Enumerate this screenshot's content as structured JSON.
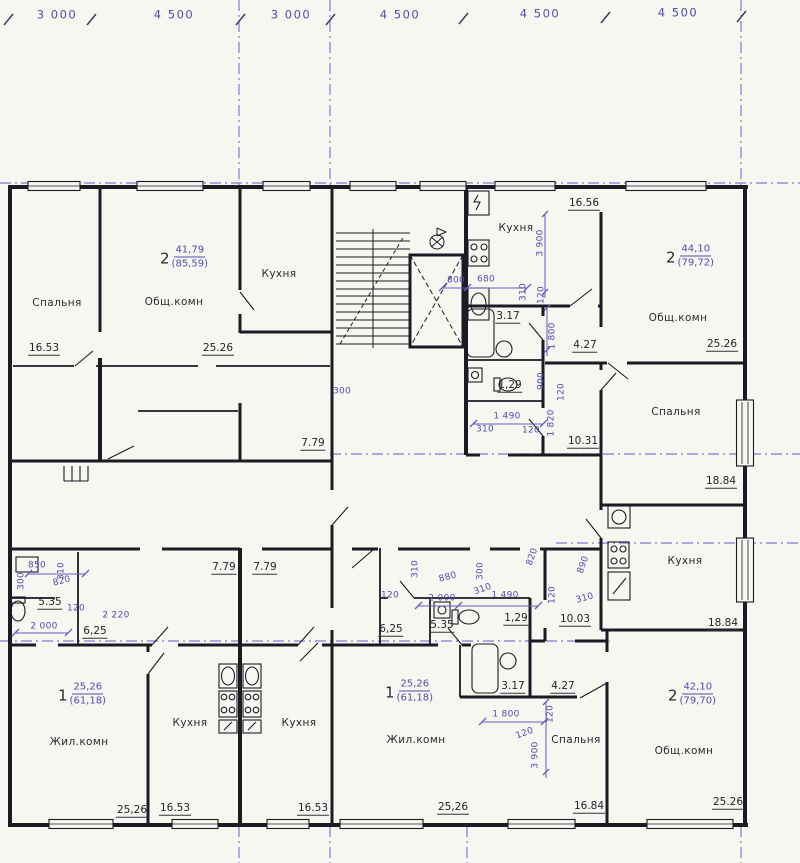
{
  "colors": {
    "paper": "#f7f6f1",
    "ink": "#1b1b24",
    "blue": "#4e4eae",
    "axis": "#7c7cd0"
  },
  "grid_dimensions": [
    {
      "text": "3 000",
      "x": 57,
      "y": 15
    },
    {
      "text": "4 500",
      "x": 174,
      "y": 15
    },
    {
      "text": "3 000",
      "x": 291,
      "y": 15
    },
    {
      "text": "4 500",
      "x": 400,
      "y": 15
    },
    {
      "text": "4 500",
      "x": 540,
      "y": 14
    },
    {
      "text": "4 500",
      "x": 678,
      "y": 13
    }
  ],
  "room_labels": [
    {
      "text": "Спальня",
      "x": 57,
      "y": 303
    },
    {
      "text": "Общ.комн",
      "x": 174,
      "y": 302
    },
    {
      "text": "Кухня",
      "x": 279,
      "y": 274
    },
    {
      "text": "Кухня",
      "x": 516,
      "y": 228
    },
    {
      "text": "Общ.комн",
      "x": 678,
      "y": 318
    },
    {
      "text": "Спальня",
      "x": 676,
      "y": 412
    },
    {
      "text": "Кухня",
      "x": 685,
      "y": 561
    },
    {
      "text": "Общ.комн",
      "x": 684,
      "y": 751
    },
    {
      "text": "Спальня",
      "x": 576,
      "y": 740
    },
    {
      "text": "Жил.комн",
      "x": 416,
      "y": 740
    },
    {
      "text": "Жил.комн",
      "x": 79,
      "y": 742
    },
    {
      "text": "Кухня",
      "x": 190,
      "y": 723
    },
    {
      "text": "Кухня",
      "x": 299,
      "y": 723
    }
  ],
  "area_labels": [
    {
      "text": "16.53",
      "x": 44,
      "y": 349
    },
    {
      "text": "25.26",
      "x": 218,
      "y": 349
    },
    {
      "text": "16.56",
      "x": 584,
      "y": 204
    },
    {
      "text": "25.26",
      "x": 722,
      "y": 345
    },
    {
      "text": "4.27",
      "x": 585,
      "y": 346
    },
    {
      "text": "3.17",
      "x": 508,
      "y": 317
    },
    {
      "text": "1,29",
      "x": 510,
      "y": 386
    },
    {
      "text": "10.31",
      "x": 583,
      "y": 442
    },
    {
      "text": "18.84",
      "x": 721,
      "y": 482
    },
    {
      "text": "18.84",
      "x": 723,
      "y": 624
    },
    {
      "text": "10.03",
      "x": 575,
      "y": 620
    },
    {
      "text": "7.79",
      "x": 313,
      "y": 444
    },
    {
      "text": "7.79",
      "x": 224,
      "y": 568
    },
    {
      "text": "7.79",
      "x": 265,
      "y": 568
    },
    {
      "text": "5.35",
      "x": 50,
      "y": 603
    },
    {
      "text": "6,25",
      "x": 95,
      "y": 632
    },
    {
      "text": "5.35",
      "x": 442,
      "y": 626
    },
    {
      "text": "6,25",
      "x": 391,
      "y": 630
    },
    {
      "text": "1,29",
      "x": 516,
      "y": 619
    },
    {
      "text": "3.17",
      "x": 513,
      "y": 687
    },
    {
      "text": "4.27",
      "x": 563,
      "y": 687
    },
    {
      "text": "16.84",
      "x": 589,
      "y": 807
    },
    {
      "text": "25.26",
      "x": 728,
      "y": 803
    },
    {
      "text": "25,26",
      "x": 132,
      "y": 811
    },
    {
      "text": "16.53",
      "x": 175,
      "y": 809
    },
    {
      "text": "16.53",
      "x": 313,
      "y": 809
    },
    {
      "text": "25,26",
      "x": 453,
      "y": 808
    }
  ],
  "apartment_labels": [
    {
      "num": "2",
      "area": "41,79",
      "total": "(85,59)",
      "x": 184,
      "y": 257
    },
    {
      "num": "2",
      "area": "44,10",
      "total": "(79,72)",
      "x": 690,
      "y": 256
    },
    {
      "num": "2",
      "area": "42,10",
      "total": "(79,70)",
      "x": 692,
      "y": 694
    },
    {
      "num": "1",
      "area": "25,26",
      "total": "(61,18)",
      "x": 409,
      "y": 691
    },
    {
      "num": "1",
      "area": "25,26",
      "total": "(61,18)",
      "x": 82,
      "y": 694
    }
  ],
  "dim_labels": [
    {
      "text": "800",
      "x": 456,
      "y": 281,
      "rot": 0
    },
    {
      "text": "680",
      "x": 486,
      "y": 280,
      "rot": 0
    },
    {
      "text": "3 900",
      "x": 541,
      "y": 243,
      "rot": -90
    },
    {
      "text": "310",
      "x": 524,
      "y": 292,
      "rot": -90
    },
    {
      "text": "120",
      "x": 542,
      "y": 295,
      "rot": -90
    },
    {
      "text": "1 800",
      "x": 553,
      "y": 336,
      "rot": -90
    },
    {
      "text": "900",
      "x": 542,
      "y": 381,
      "rot": -90
    },
    {
      "text": "120",
      "x": 562,
      "y": 392,
      "rot": -90
    },
    {
      "text": "1 490",
      "x": 507,
      "y": 417,
      "rot": 0
    },
    {
      "text": "310",
      "x": 485,
      "y": 430,
      "rot": 0
    },
    {
      "text": "120",
      "x": 531,
      "y": 431,
      "rot": 0
    },
    {
      "text": "1 820",
      "x": 552,
      "y": 423,
      "rot": -90
    },
    {
      "text": "300",
      "x": 342,
      "y": 392,
      "rot": 0
    },
    {
      "text": "890",
      "x": 584,
      "y": 565,
      "rot": -70
    },
    {
      "text": "310",
      "x": 585,
      "y": 599,
      "rot": -15
    },
    {
      "text": "850",
      "x": 37,
      "y": 566,
      "rot": 0
    },
    {
      "text": "310",
      "x": 62,
      "y": 571,
      "rot": -90
    },
    {
      "text": "820",
      "x": 62,
      "y": 582,
      "rot": -15
    },
    {
      "text": "300",
      "x": 22,
      "y": 581,
      "rot": -90
    },
    {
      "text": "120",
      "x": 76,
      "y": 609,
      "rot": 0
    },
    {
      "text": "2 220",
      "x": 116,
      "y": 616,
      "rot": 0
    },
    {
      "text": "2 000",
      "x": 44,
      "y": 627,
      "rot": 0
    },
    {
      "text": "310",
      "x": 416,
      "y": 569,
      "rot": -90
    },
    {
      "text": "880",
      "x": 448,
      "y": 578,
      "rot": -15
    },
    {
      "text": "120",
      "x": 390,
      "y": 596,
      "rot": 0
    },
    {
      "text": "2 000",
      "x": 442,
      "y": 599,
      "rot": 0
    },
    {
      "text": "300",
      "x": 481,
      "y": 571,
      "rot": -90
    },
    {
      "text": "310",
      "x": 483,
      "y": 590,
      "rot": -20
    },
    {
      "text": "1 490",
      "x": 505,
      "y": 596,
      "rot": 0
    },
    {
      "text": "820",
      "x": 533,
      "y": 557,
      "rot": -70
    },
    {
      "text": "120",
      "x": 553,
      "y": 595,
      "rot": -90
    },
    {
      "text": "1 800",
      "x": 506,
      "y": 715,
      "rot": 0
    },
    {
      "text": "120",
      "x": 551,
      "y": 714,
      "rot": -90
    },
    {
      "text": "120",
      "x": 525,
      "y": 734,
      "rot": -20
    },
    {
      "text": "3 900",
      "x": 536,
      "y": 755,
      "rot": -90
    }
  ]
}
